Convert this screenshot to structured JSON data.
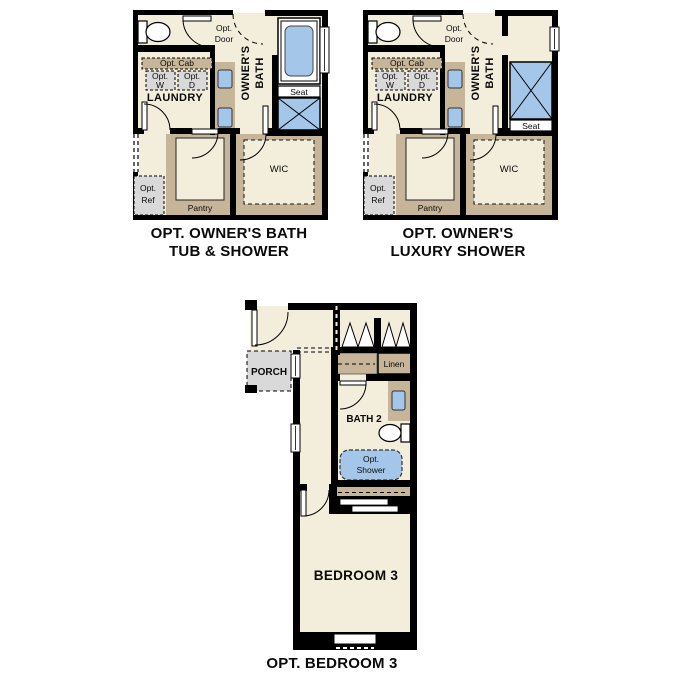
{
  "colors": {
    "wall": "#000000",
    "floor": "#F3EDDC",
    "tan": "#C6B598",
    "gray": "#D9D9D9",
    "fixture_blue": "#A4C6E9"
  },
  "plan1": {
    "caption1": "OPT. OWNER'S BATH",
    "caption2": "TUB & SHOWER",
    "owners_bath1": "OWNER'S",
    "owners_bath2": "BATH",
    "opt_door1": "Opt.",
    "opt_door2": "Door",
    "opt_cab": "Opt. Cab",
    "opt_w1": "Opt.",
    "opt_w2": "W",
    "opt_d1": "Opt.",
    "opt_d2": "D",
    "laundry": "LAUNDRY",
    "opt_ref1": "Opt.",
    "opt_ref2": "Ref",
    "pantry": "Pantry",
    "wic": "WIC",
    "seat": "Seat"
  },
  "plan2": {
    "caption1": "OPT. OWNER'S",
    "caption2": "LUXURY SHOWER",
    "owners_bath1": "OWNER'S",
    "owners_bath2": "BATH",
    "opt_door1": "Opt.",
    "opt_door2": "Door",
    "opt_cab": "Opt. Cab",
    "opt_w1": "Opt.",
    "opt_w2": "W",
    "opt_d1": "Opt.",
    "opt_d2": "D",
    "laundry": "LAUNDRY",
    "opt_ref1": "Opt.",
    "opt_ref2": "Ref",
    "pantry": "Pantry",
    "wic": "WIC",
    "seat": "Seat"
  },
  "plan3": {
    "caption": "OPT. BEDROOM 3",
    "porch": "PORCH",
    "linen": "Linen",
    "bath": "BATH 2",
    "opt_shower1": "Opt.",
    "opt_shower2": "Shower",
    "bedroom": "BEDROOM 3"
  }
}
